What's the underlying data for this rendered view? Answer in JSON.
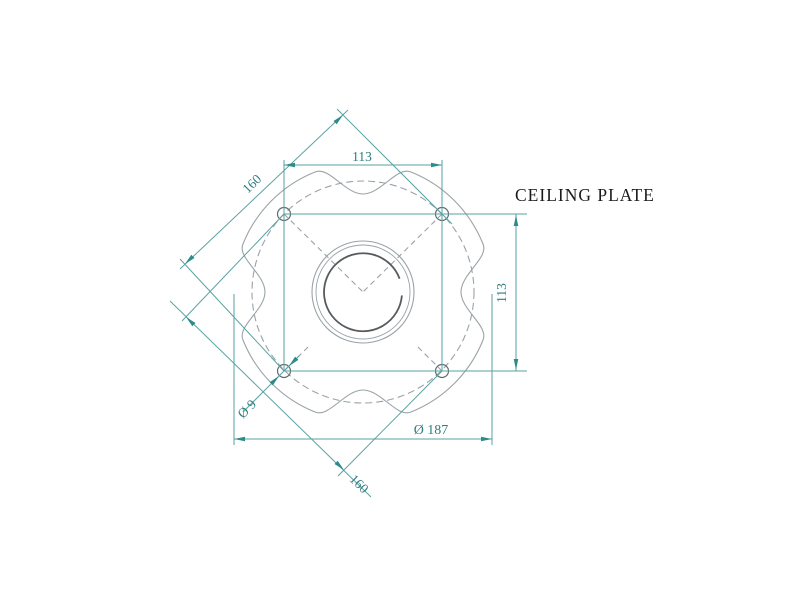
{
  "title": {
    "label": "CEILING PLATE"
  },
  "drawing": {
    "type": "technical-drawing-top-view",
    "part": "ceiling plate",
    "dimensions": {
      "bolt_spacing_horizontal": {
        "label": "113",
        "value": 113,
        "unit": "mm"
      },
      "bolt_spacing_vertical": {
        "label": "113",
        "value": 113,
        "unit": "mm"
      },
      "bolt_diagonal_upper": {
        "label": "160",
        "value": 160,
        "unit": "mm"
      },
      "bolt_diagonal_lower": {
        "label": "160",
        "value": 160,
        "unit": "mm"
      },
      "bolt_hole_diameter": {
        "label": "Ø 9",
        "value": 9,
        "unit": "mm"
      },
      "plate_diameter": {
        "label": "Ø 187",
        "value": 187,
        "unit": "mm"
      }
    },
    "features": {
      "bolt_holes": 4,
      "scallop_notches": 4,
      "center_opening": "circular with double rim"
    }
  },
  "colors": {
    "background": "#ffffff",
    "dimension_line": "#5aa2a2",
    "dimension_arrow": "#2e8b8b",
    "dimension_text": "#2f7e80",
    "geometry_line": "#9aa3a7",
    "geometry_dark": "#565b5e",
    "title_text": "#1b1b1b"
  }
}
